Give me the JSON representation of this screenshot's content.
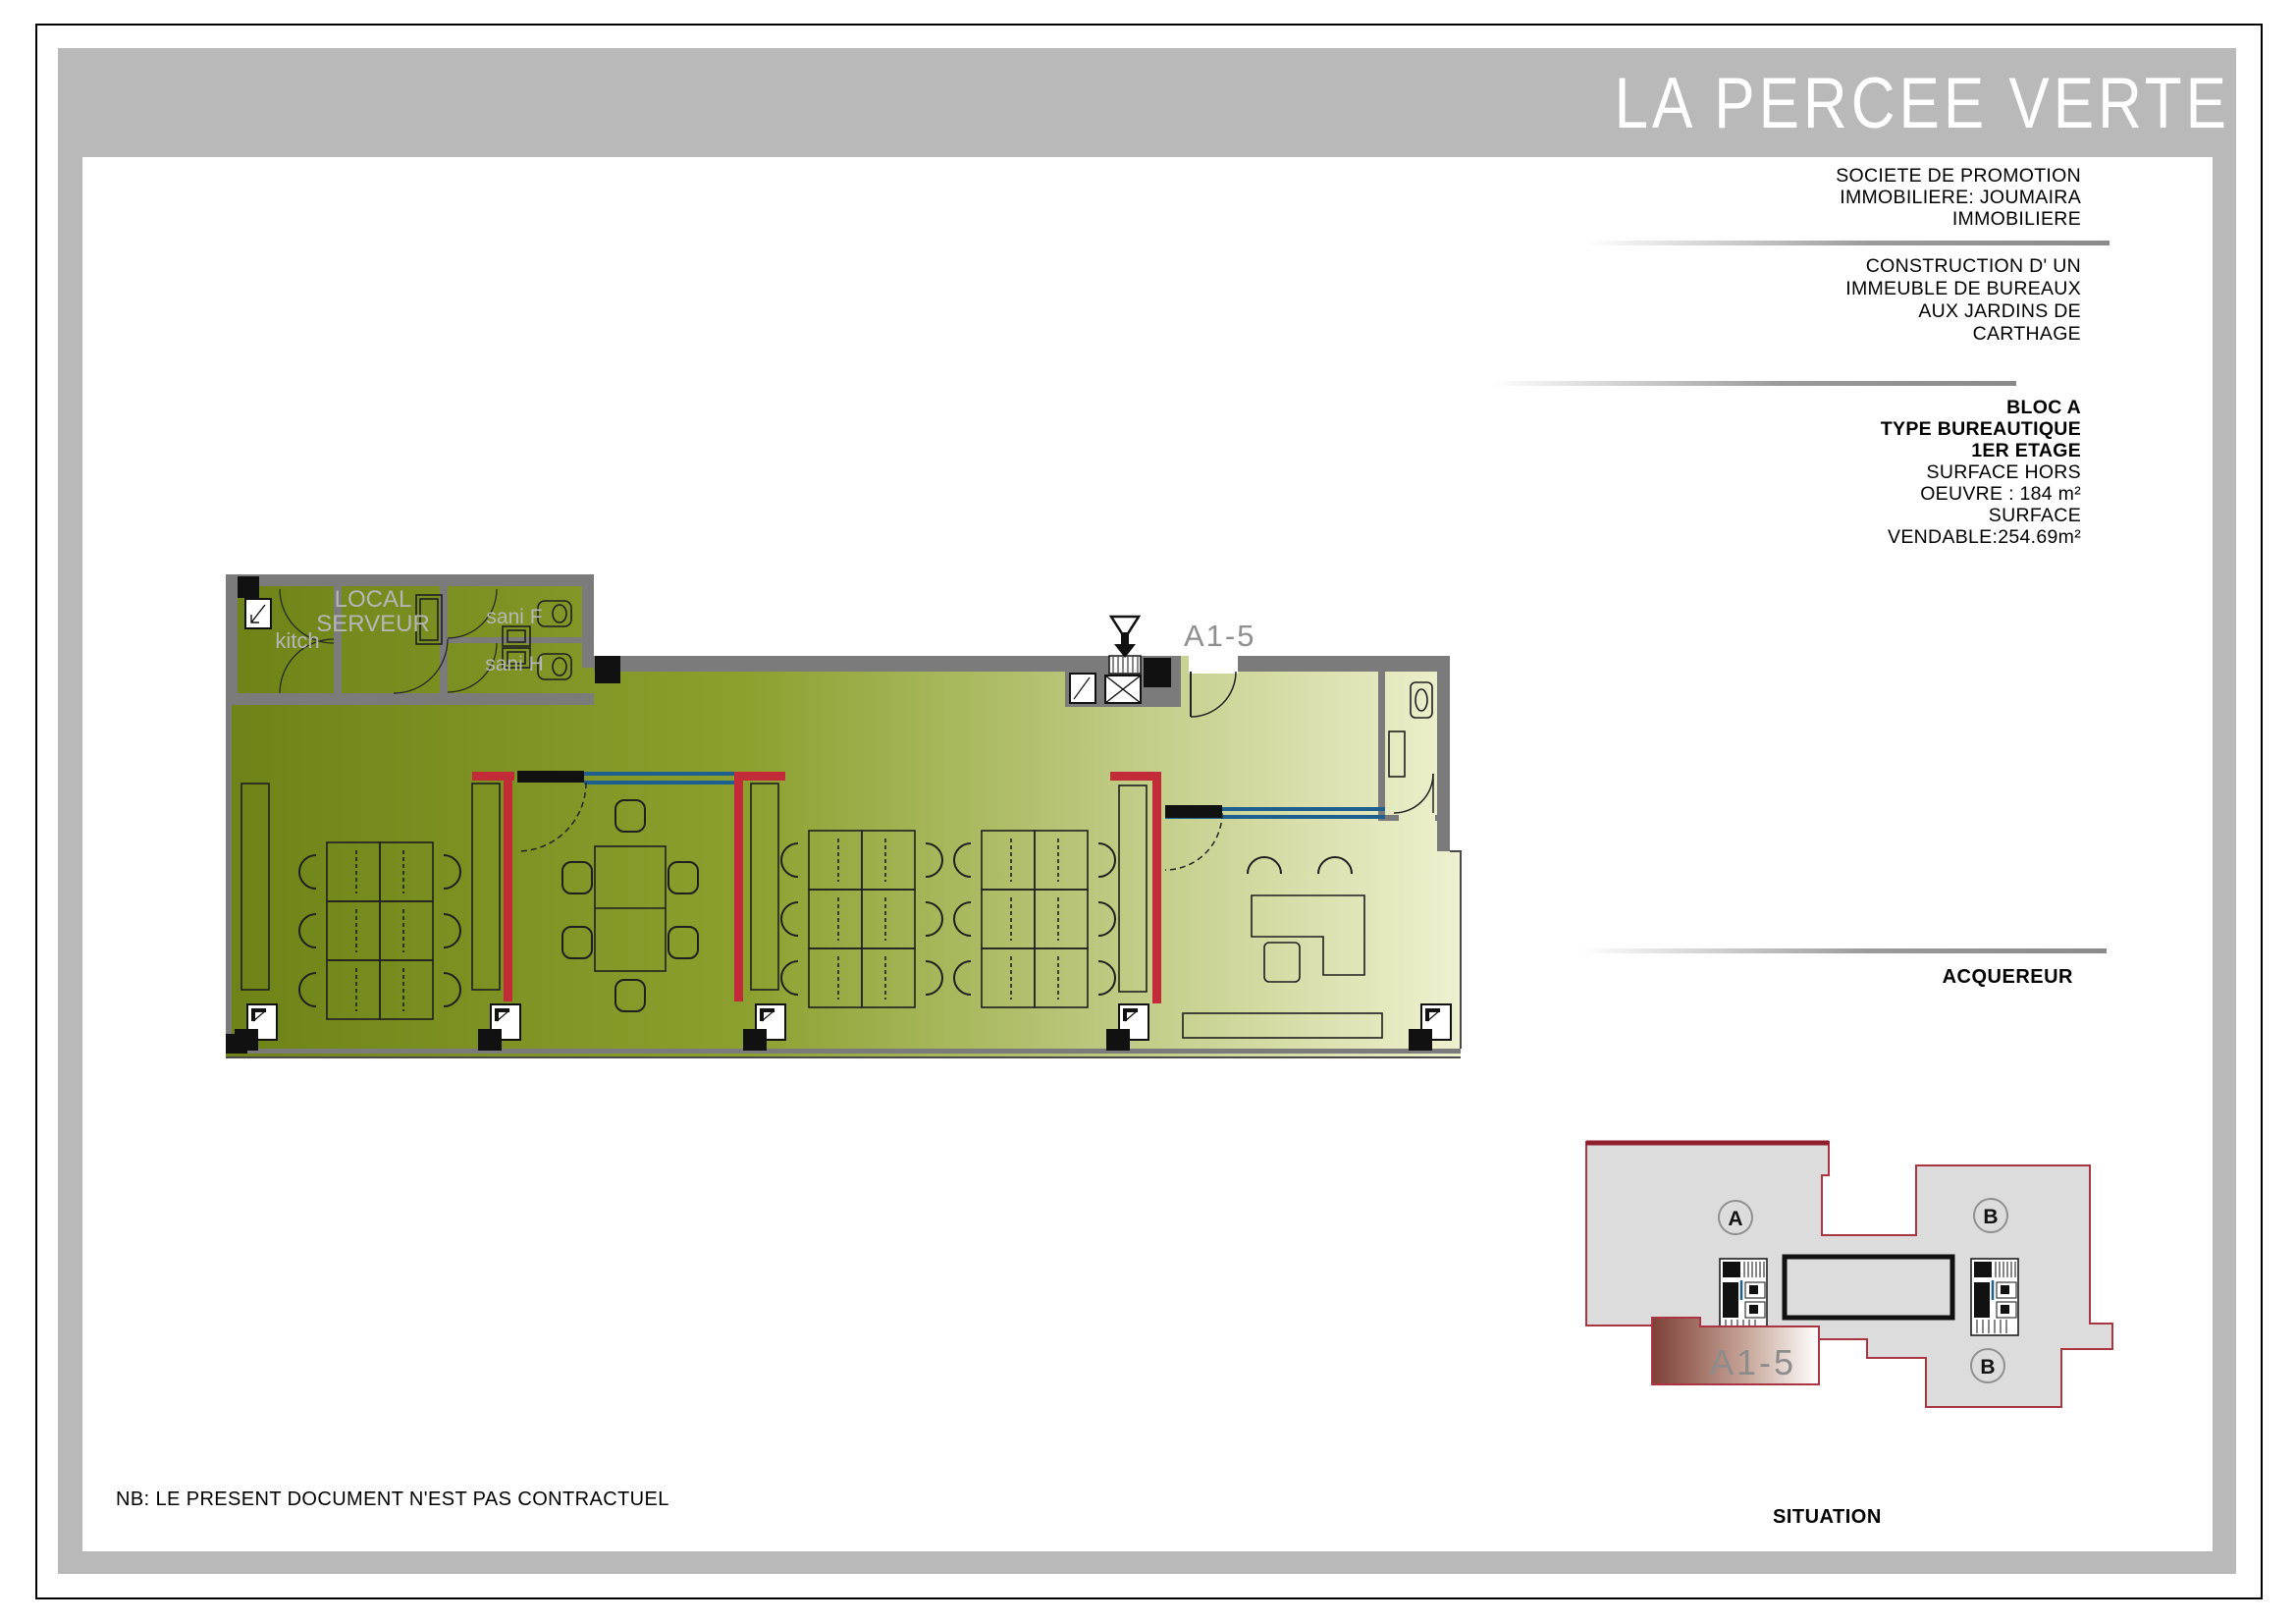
{
  "title": "LA PERCEE VERTE",
  "company": {
    "line1": "SOCIETE DE PROMOTION",
    "line2": "IMMOBILIERE: JOUMAIRA",
    "line3": "IMMOBILIERE"
  },
  "project": {
    "line1": "CONSTRUCTION  D' UN",
    "line2": "IMMEUBLE DE BUREAUX",
    "line3": "AUX  JARDINS DE",
    "line4": "CARTHAGE"
  },
  "unit_info": {
    "bloc": "BLOC A",
    "type": "TYPE BUREAUTIQUE",
    "etage": "1ER ETAGE",
    "surface1": "SURFACE HORS",
    "surface2": "OEUVRE : 184 m²",
    "surface3": "SURFACE",
    "surface4": "VENDABLE:254.69m²"
  },
  "acquereur": "ACQUEREUR",
  "note": "NB: LE PRESENT DOCUMENT N'EST PAS CONTRACTUEL",
  "situation_title": "SITUATION",
  "plan": {
    "unit_label": "A1-5",
    "kitchen": "kitch",
    "server_line1": "LOCAL",
    "server_line2": "SERVEUR",
    "sani_f": "sani F",
    "sani_h": "sani H"
  },
  "situation": {
    "unit_label": "A1-5",
    "block_a": "A",
    "block_b_top": "B",
    "block_b_bottom": "B"
  },
  "colors": {
    "frame_gray": "#b9b9b9",
    "wall_gray": "#7b7b7b",
    "floor_dark": "#6e8317",
    "floor_light": "#eef1cf",
    "partition_red": "#c32b38",
    "glass_blue": "#1d5f8f",
    "situation_fill": "#dcdcdc",
    "situation_border": "#a93543",
    "highlight_dark": "#7e4037",
    "label_gray": "#8c8c8c"
  }
}
